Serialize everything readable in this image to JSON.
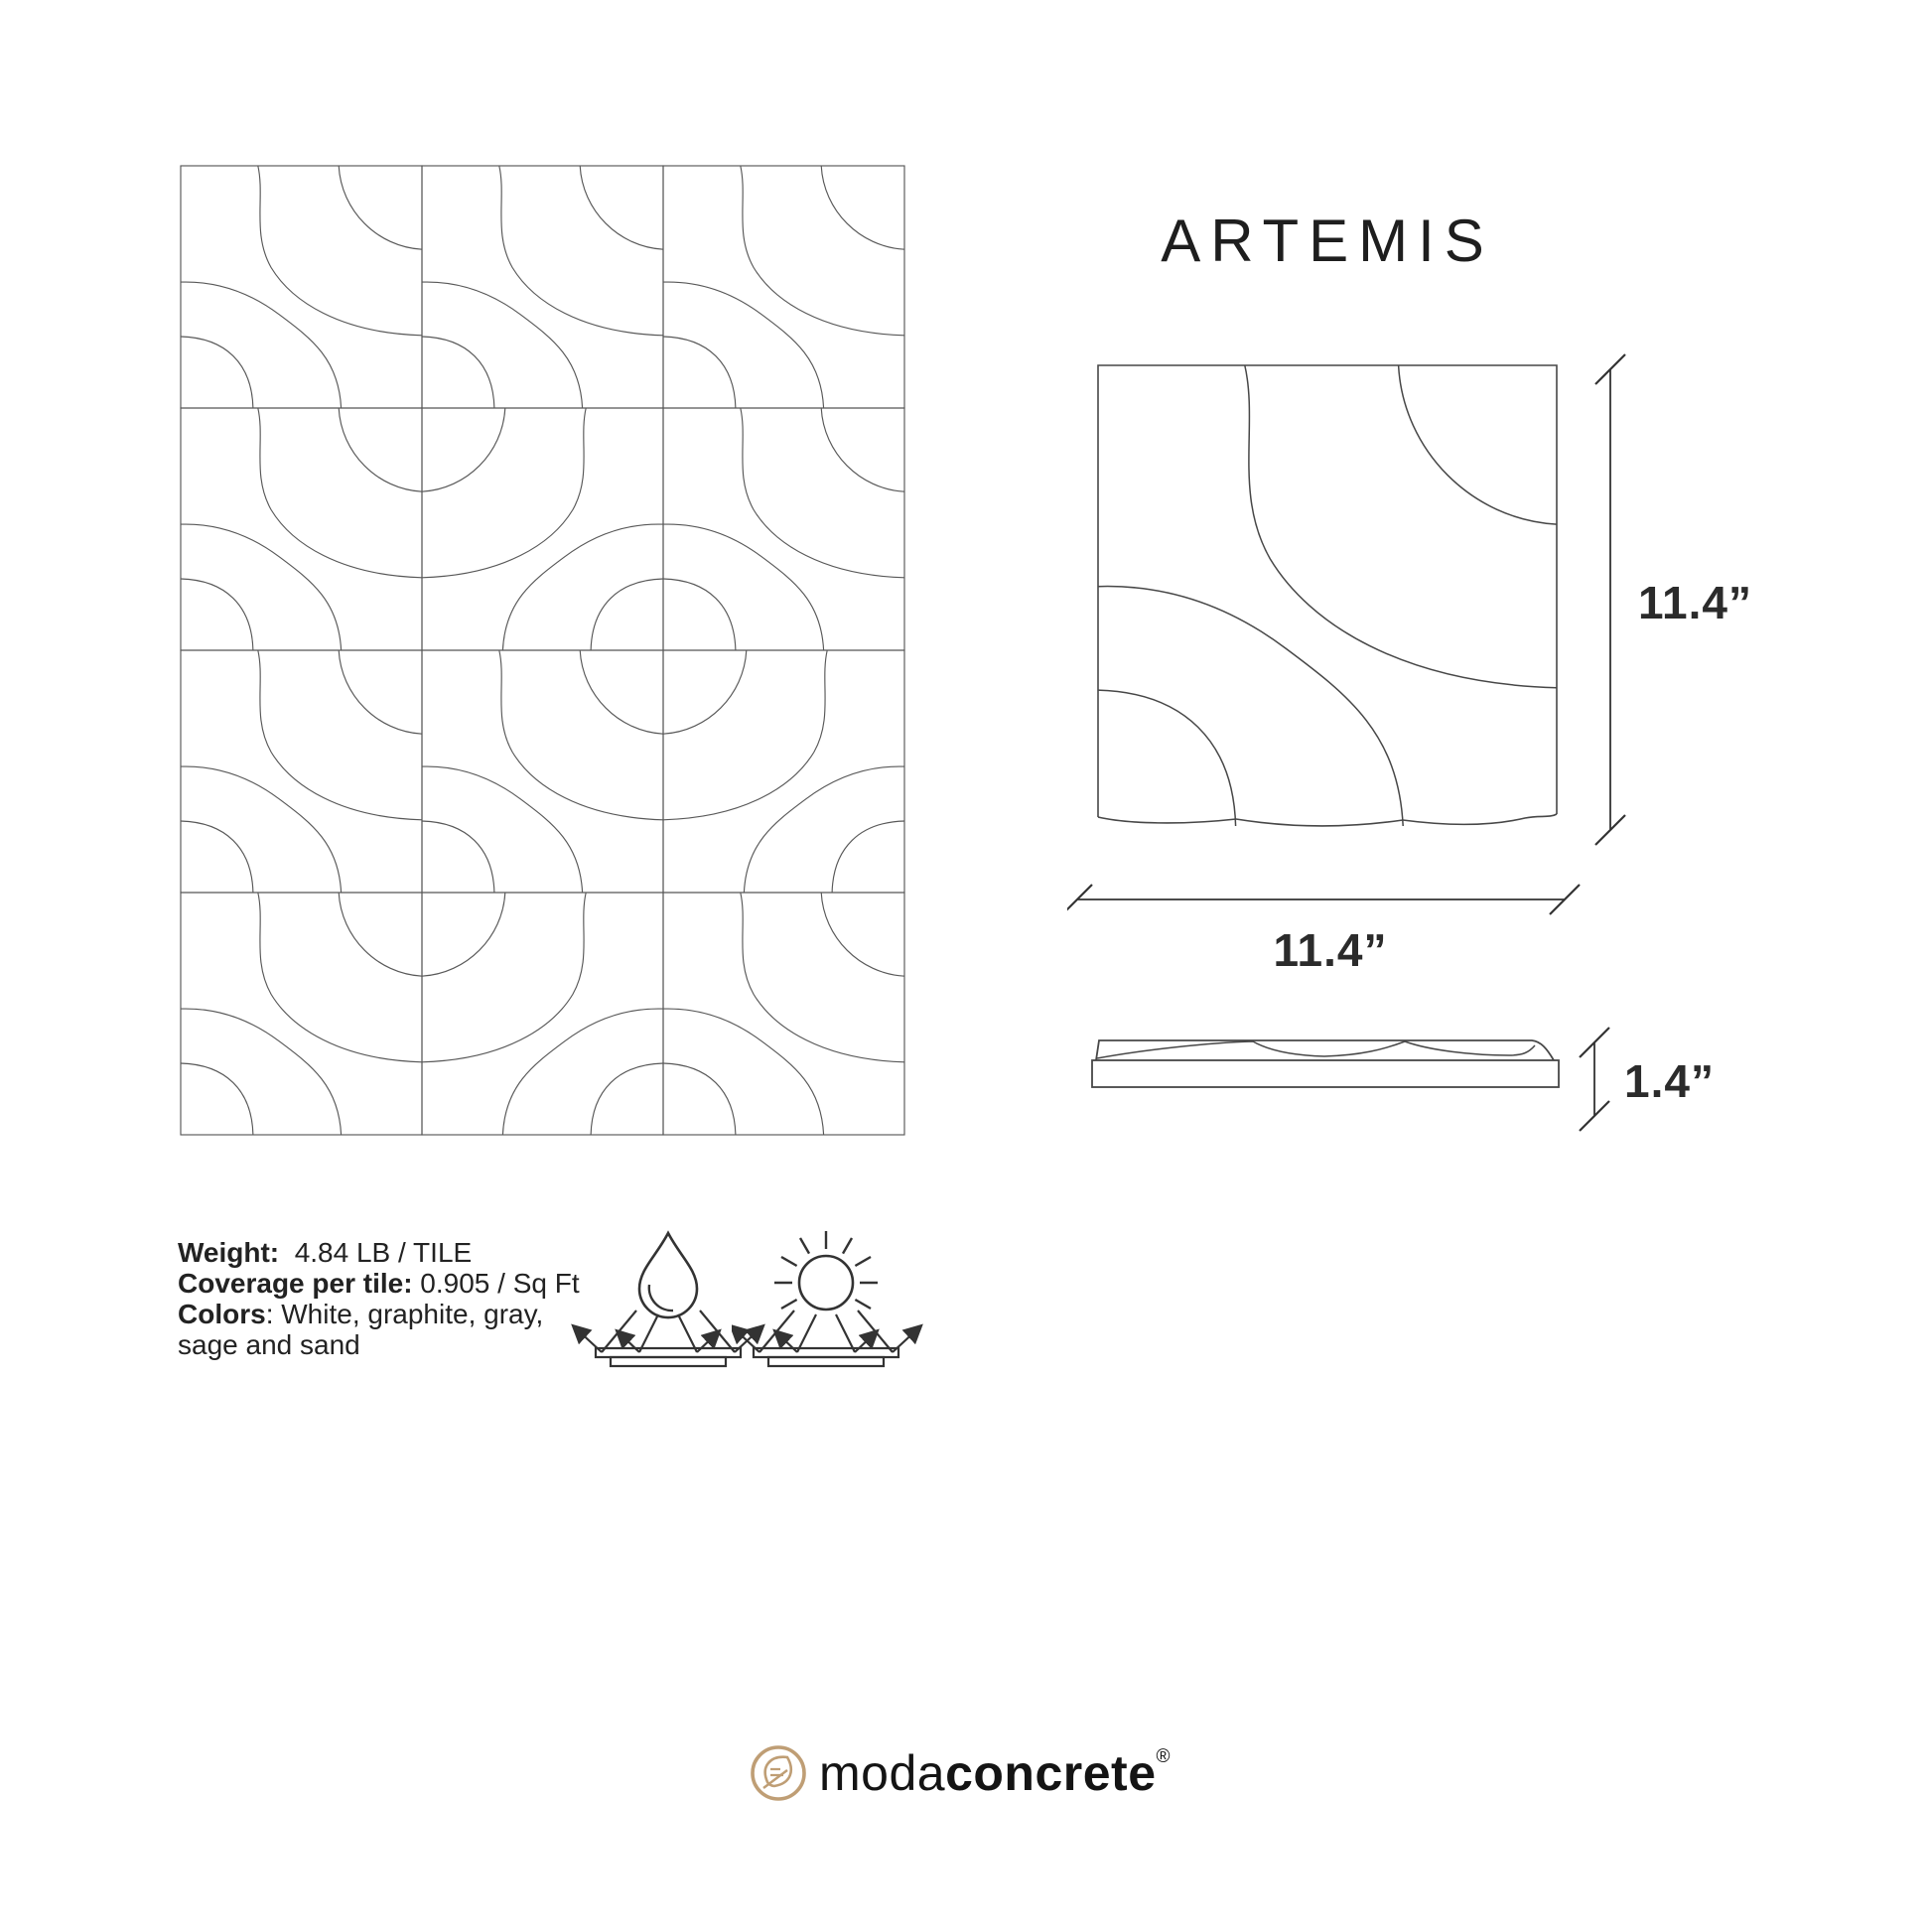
{
  "title": "ARTEMIS",
  "drawing": {
    "width_label": "11.4”",
    "height_label": "11.4”",
    "thickness_label": "1.4”"
  },
  "specs": {
    "lines": [
      {
        "bold": "Weight:",
        "rest": "  4.84 LB / TILE"
      },
      {
        "bold": "Coverage per tile:",
        "rest": " 0.905 / Sq Ft"
      },
      {
        "bold": "Colors",
        "rest": ": White, graphite, gray,"
      },
      {
        "bold": "",
        "rest": "sage and sand"
      }
    ]
  },
  "icons": [
    {
      "name": "water-drop-icon"
    },
    {
      "name": "sun-icon"
    }
  ],
  "logo": {
    "regular": "moda",
    "bold": "concrete",
    "registered": "®"
  },
  "palette": {
    "pattern_line": "#585858",
    "drawing_line": "#474747",
    "dimension_line": "#333333",
    "text": "#222222",
    "logo_accent": "#bf9e75"
  }
}
